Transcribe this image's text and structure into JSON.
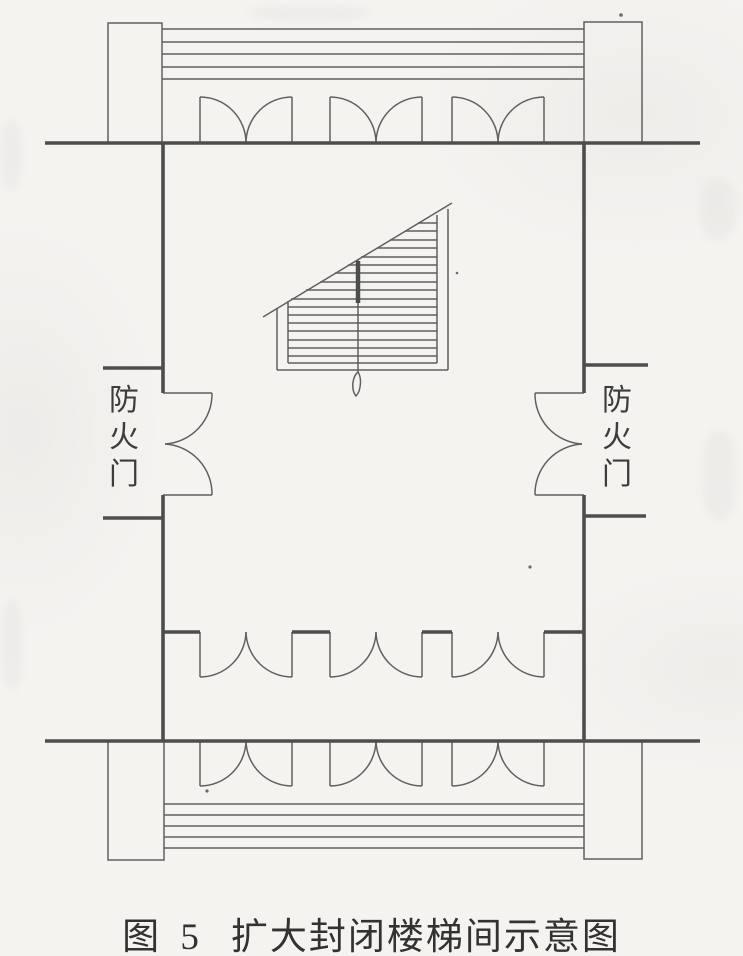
{
  "figure": {
    "caption": {
      "prefix": "图 5",
      "title": "扩大封闭楼梯间示意图"
    },
    "fire_door_label_left": "防火门",
    "fire_door_label_right": "防火门"
  },
  "icons": {
    "door_swing": "quarter-circle-arc",
    "stair_break_line": "diagonal-cut-line",
    "stair_direction_tail": "teardrop-loop"
  },
  "colors": {
    "paper": "#f5f3f0",
    "ink_thick_wall": "#4d4d4d",
    "ink_thin_line": "#606060",
    "label_text": "#3c3c3c",
    "caption_text": "#323232"
  }
}
